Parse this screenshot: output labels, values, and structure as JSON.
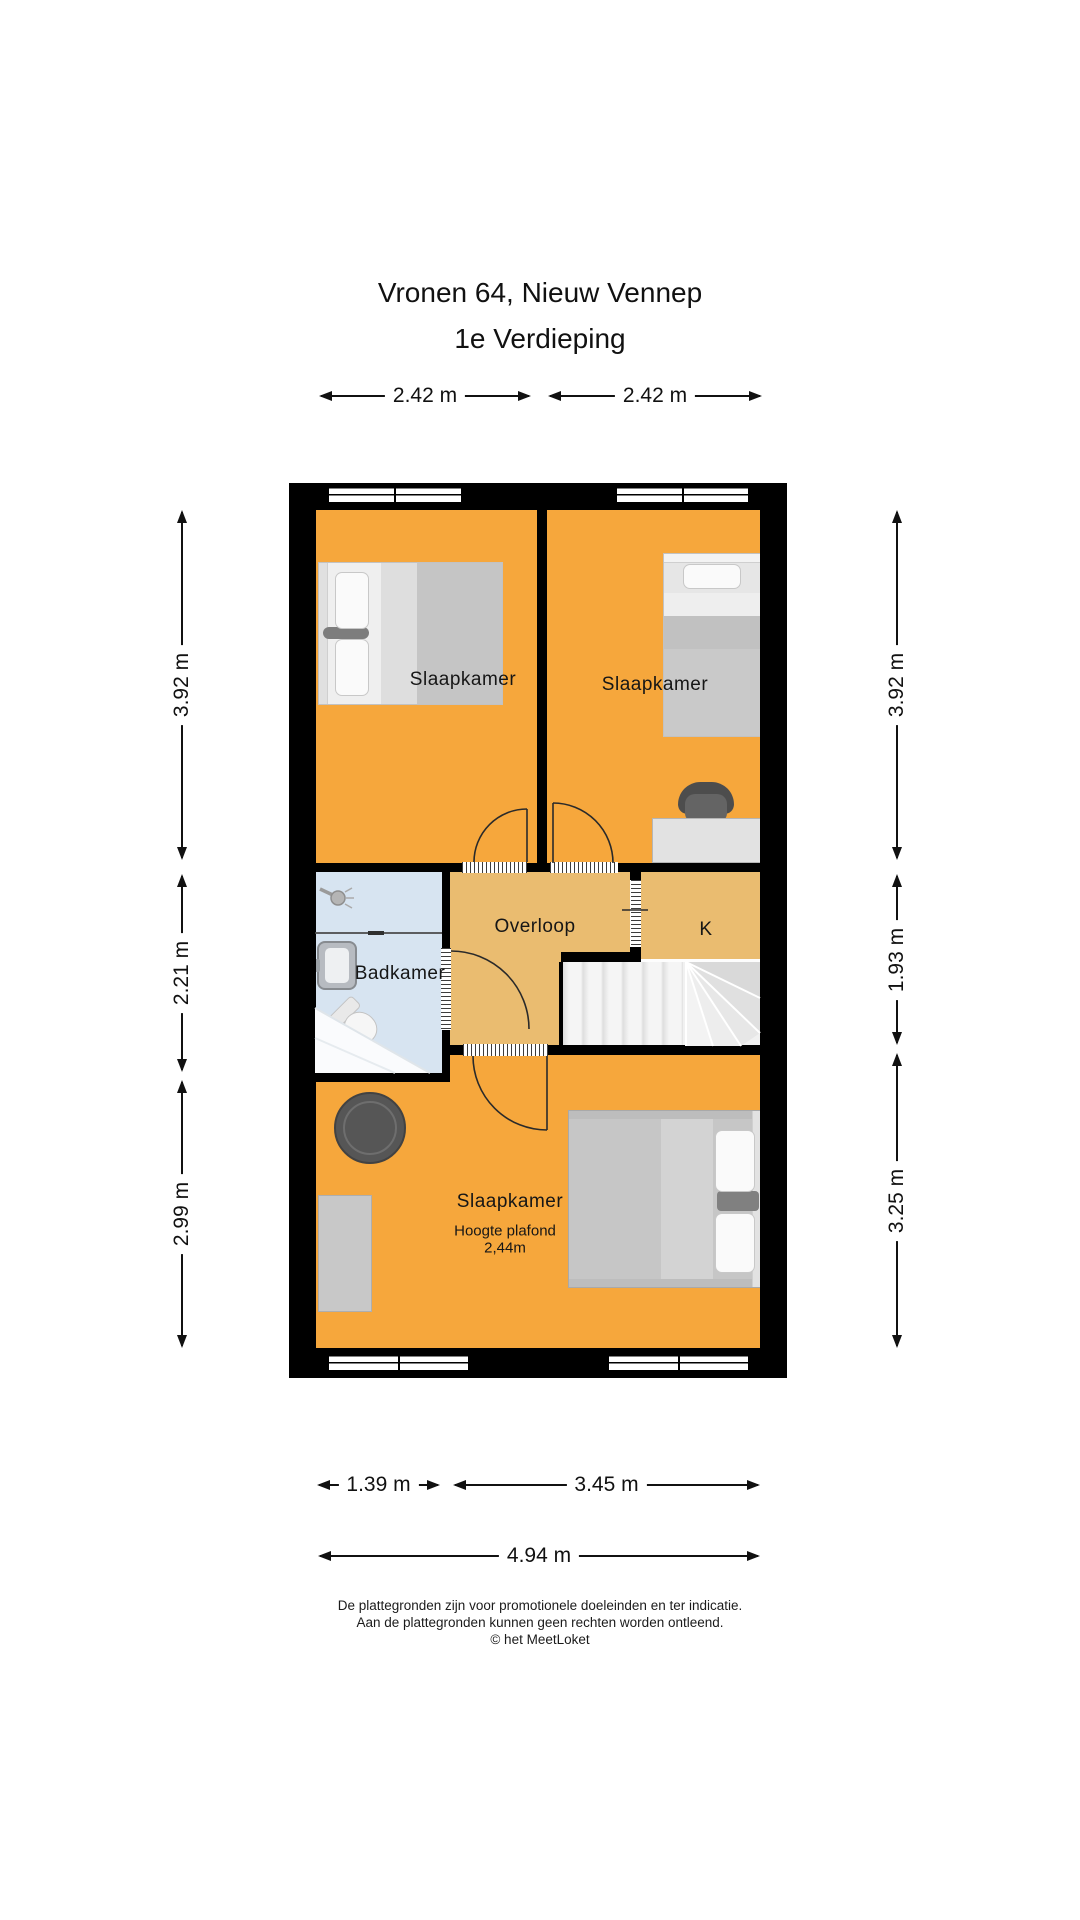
{
  "title": {
    "line1": "Vronen 64, Nieuw Vennep",
    "line2": "1e Verdieping"
  },
  "rooms": {
    "slaapkamer1": {
      "label": "Slaapkamer"
    },
    "slaapkamer2": {
      "label": "Slaapkamer"
    },
    "badkamer": {
      "label": "Badkamer"
    },
    "overloop": {
      "label": "Overloop"
    },
    "kast": {
      "label": "K"
    },
    "slaapkamer3": {
      "label": "Slaapkamer",
      "note1": "Hoogte plafond",
      "note2": "2,44m"
    }
  },
  "dimensions": {
    "top": [
      {
        "label": "2.42 m"
      },
      {
        "label": "2.42 m"
      }
    ],
    "left": [
      {
        "label": "3.92 m"
      },
      {
        "label": "2.21 m"
      },
      {
        "label": "2.99 m"
      }
    ],
    "right": [
      {
        "label": "3.92 m"
      },
      {
        "label": "1.93 m"
      },
      {
        "label": "3.25 m"
      }
    ],
    "bottom": [
      {
        "label": "1.39 m"
      },
      {
        "label": "3.45 m"
      },
      {
        "label": "4.94 m"
      }
    ]
  },
  "footer": {
    "line1": "De plattegronden zijn voor promotionele doeleinden en ter indicatie.",
    "line2": "Aan de plattegronden kunnen geen rechten worden ontleend.",
    "line3": "© het MeetLoket"
  },
  "colors": {
    "room-orange": "#F6A73C",
    "hall-tan": "#EABC70",
    "bath-blue": "#D7E4F1",
    "wall-black": "#000000",
    "stairs-gray": "#F1F1F1"
  }
}
